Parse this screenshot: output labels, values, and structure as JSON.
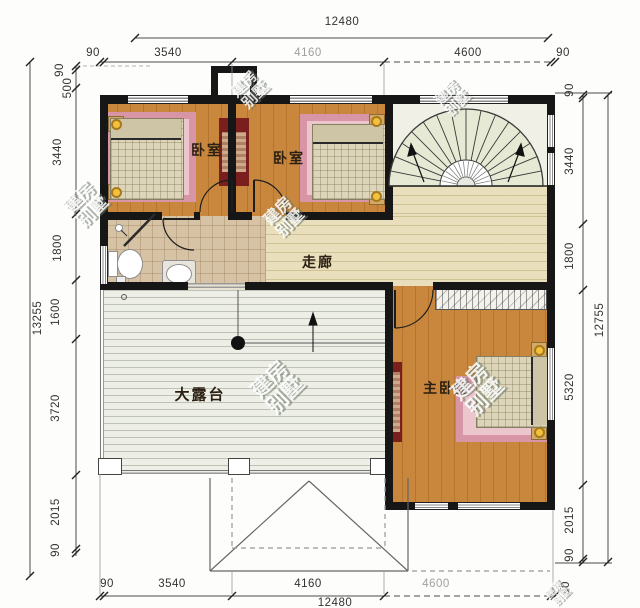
{
  "dims": {
    "top_total": "12480",
    "top_chain": [
      "90",
      "3540",
      "4160",
      "4600",
      "90"
    ],
    "bottom_chain": [
      "90",
      "3540",
      "4160",
      "4600",
      "90"
    ],
    "bottom_total": "12480",
    "left_total": "13255",
    "left_chain": [
      "90",
      "500",
      "3440",
      "1800",
      "1600",
      "3720",
      "2015",
      "90"
    ],
    "right_total": "12755",
    "right_chain": [
      "90",
      "3440",
      "1800",
      "5320",
      "2015",
      "90"
    ]
  },
  "rooms": {
    "bedroom_left": "卧室",
    "bedroom_middle": "卧室",
    "corridor": "走廊",
    "terrace": "大露台",
    "master_bedroom": "主卧室"
  },
  "watermark": {
    "line1": "建房",
    "line2": "别墅"
  },
  "colors": {
    "wall": "#161616",
    "wood_floor": "#c8873d",
    "corridor_floor": "#e9dfbc",
    "bathroom_floor": "#d6c2a4",
    "terrace_floor": "#edefe7",
    "stair_fill": "#e6e9d4",
    "rug_pink": "#d795a5",
    "rug_pink_inner": "#ecc6cd",
    "bed_blanket": "#dcd5ba",
    "wardrobe_red": "#7a1e1e",
    "lamp_yellow": "#f2c23c"
  }
}
